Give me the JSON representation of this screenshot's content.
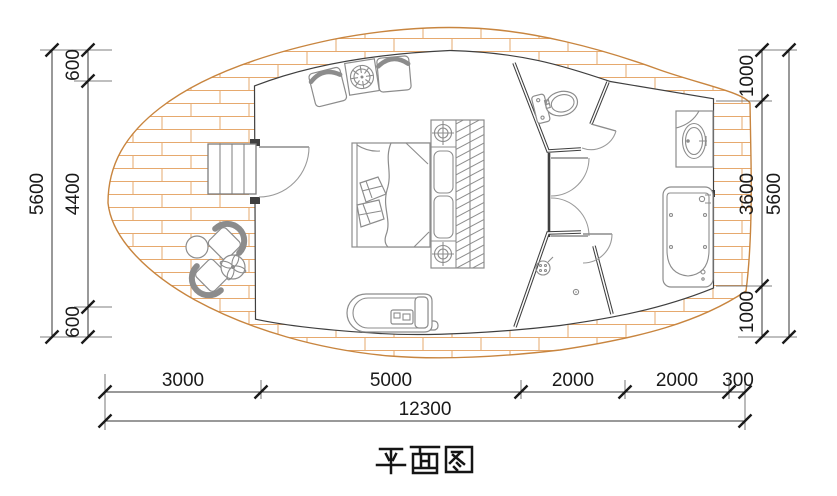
{
  "title": {
    "text": "平面图"
  },
  "dimensions": {
    "left": {
      "overall": "5600",
      "segments": [
        "600",
        "4400",
        "600"
      ]
    },
    "right": {
      "overall": "5600",
      "segments": [
        "1000",
        "3600",
        "1000"
      ]
    },
    "bottom": {
      "overall": "12300",
      "segments": [
        "3000",
        "5000",
        "2000",
        "2000",
        "300"
      ]
    }
  },
  "fixtures": [
    "deck",
    "entry-steps",
    "entry-door",
    "bed",
    "pillows",
    "duvet",
    "dressing-unit",
    "ceiling-spotlights",
    "hanging-rail",
    "lounge-chairs",
    "burner-table",
    "daybed",
    "deck-armchairs",
    "deck-round-table",
    "deck-side-table",
    "wc-room",
    "toilet",
    "closet-doors",
    "shower-room",
    "shower-head",
    "floor-drain",
    "vanity-sink",
    "bathtub"
  ],
  "colors": {
    "deck_outline": "#c8853f",
    "deck_brick": "#e6a96e",
    "wall": "#3f3f3f",
    "furniture": "#8c8c8c",
    "dim_text": "#1a1a1a"
  }
}
